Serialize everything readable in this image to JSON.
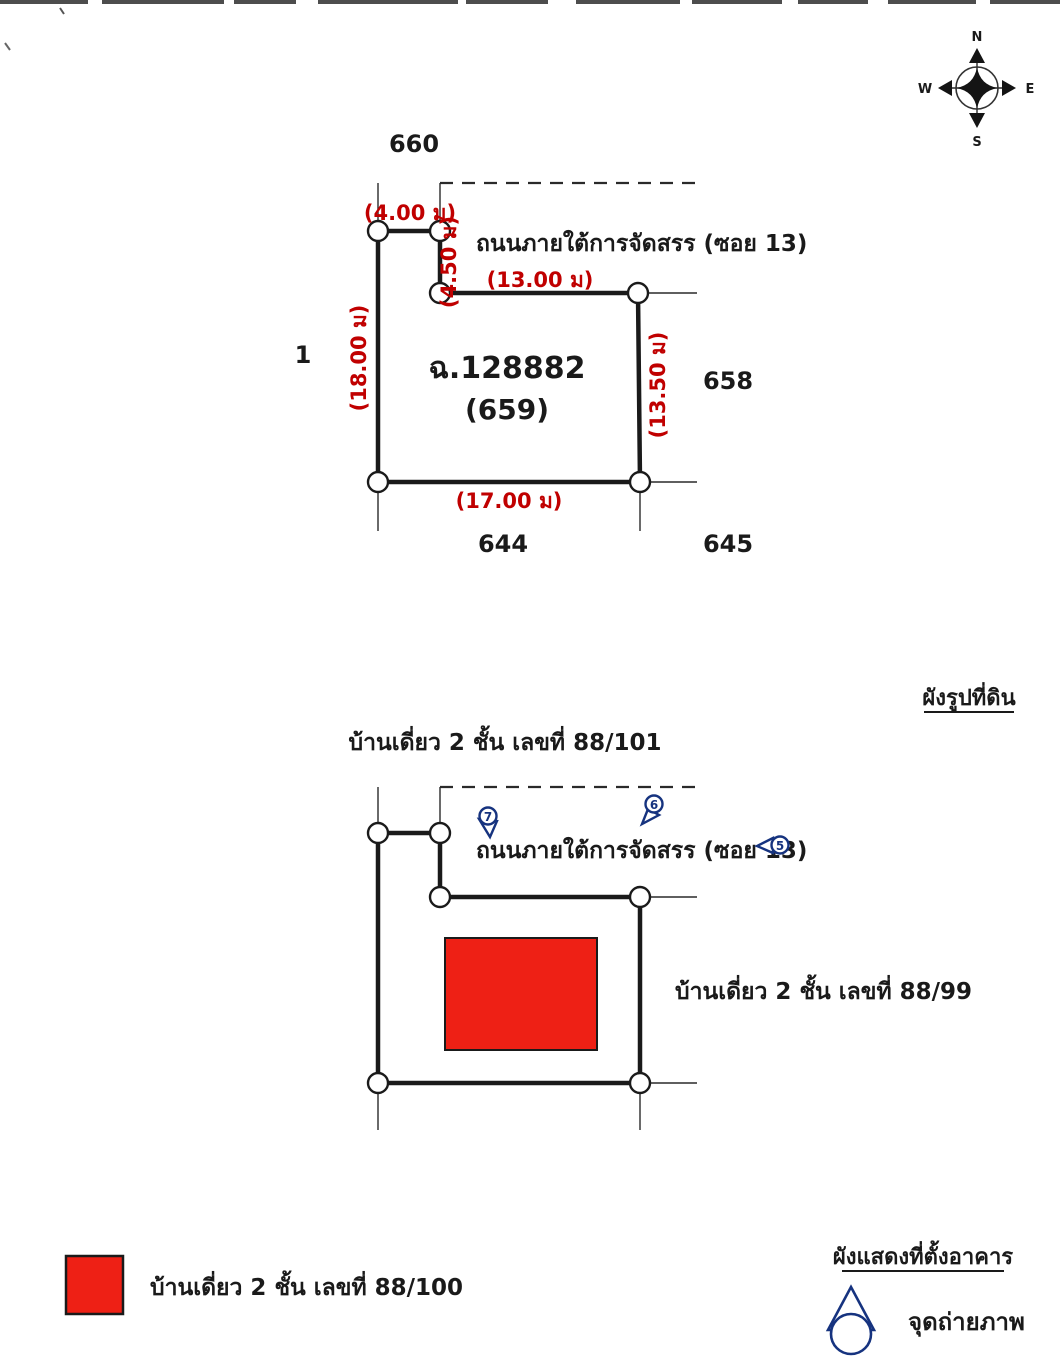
{
  "compass": {
    "north": "N",
    "south": "S",
    "east": "E",
    "west": "W"
  },
  "plan1": {
    "caption": "ผังรูปที่ดิน",
    "deed_no": "ฉ.128882",
    "plot_no": "(659)",
    "road_label": "ถนนภายใต้การจัดสรร (ซอย 13)",
    "neighbors": {
      "top": "660",
      "left": "1",
      "right": "658",
      "bottom_left": "644",
      "bottom_right": "645"
    },
    "dimensions": {
      "top": "(4.00 ม)",
      "top_vertical": "(4.50 ม)",
      "upper": "(13.00 ม)",
      "left": "(18.00 ม)",
      "right": "(13.50 ม)",
      "bottom": "(17.00 ม)"
    }
  },
  "plan2": {
    "caption": "ผังแสดงที่ตั้งอาคาร",
    "title": "บ้านเดี่ยว 2 ชั้น เลขที่ 88/101",
    "road_label": "ถนนภายใต้การจัดสรร (ซอย 13)",
    "house_right_label": "บ้านเดี่ยว 2 ชั้น เลขที่ 88/99",
    "photo_markers": {
      "m5": "5",
      "m6": "6",
      "m7": "7"
    }
  },
  "legend": {
    "building_label": "บ้านเดี่ยว 2 ชั้น เลขที่ 88/100",
    "photo_point_label": "จุดถ่ายภาพ"
  },
  "colors": {
    "dimension_red": "#c00000",
    "building_red": "#ee2015",
    "marker_blue": "#16337f",
    "line_black": "#1a1a1a"
  }
}
